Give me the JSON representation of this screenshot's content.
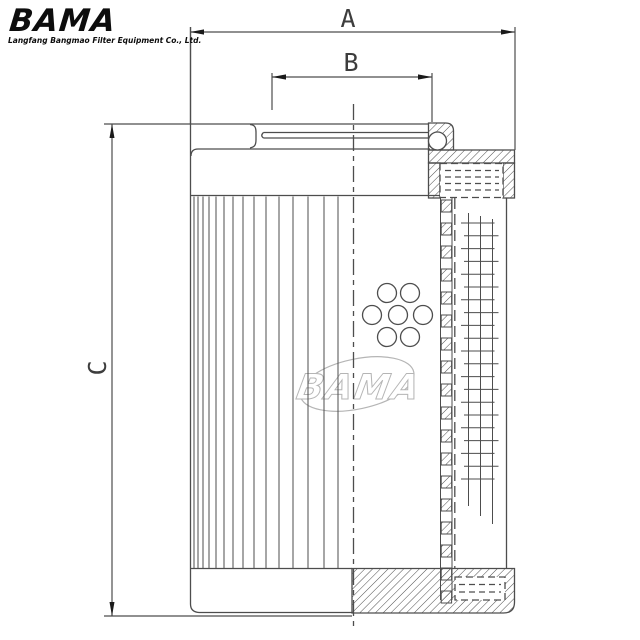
{
  "canvas": {
    "width": 640,
    "height": 640,
    "background": "#ffffff"
  },
  "logo": {
    "brand": "BAMA",
    "tagline": "Langfang Bangmao Filter Equipment Co., Ltd.",
    "color": "#0d0d0d"
  },
  "watermark": {
    "text": "BAMA",
    "color": "#b5b5b5"
  },
  "dimensions": {
    "a": {
      "label": "A"
    },
    "b": {
      "label": "B"
    },
    "c": {
      "label": "C"
    }
  },
  "drawing": {
    "line_color": "#4d4d4d",
    "arrow_color": "#1a1a1a",
    "label_color": "#3d3d3d",
    "hole_count": 7
  }
}
